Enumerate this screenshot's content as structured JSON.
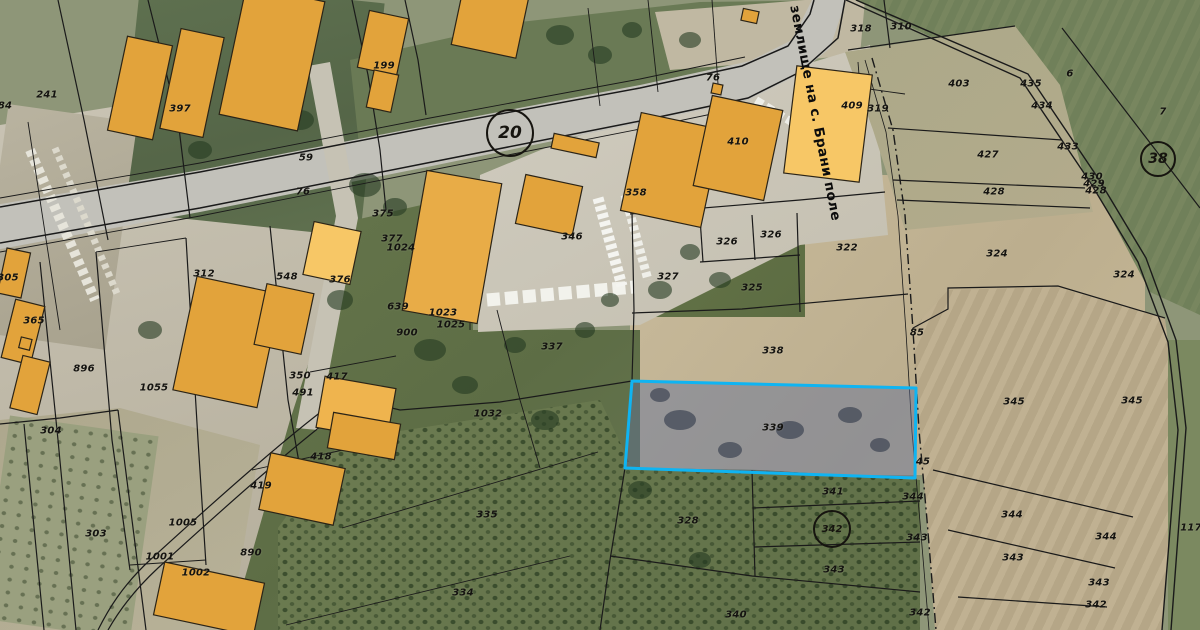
{
  "map": {
    "region_boundary_label": "землище на с. Брани поле",
    "selected_parcel": {
      "number": "339",
      "outline_color": "#0FB4F2",
      "fill_color": "rgba(96,110,152,0.45)"
    },
    "badges": [
      {
        "text": "20",
        "x": 510,
        "y": 133,
        "d": 44,
        "fs": 17
      },
      {
        "text": "38",
        "x": 1158,
        "y": 159,
        "d": 32,
        "fs": 14
      },
      {
        "text": "342",
        "x": 832,
        "y": 529,
        "d": 34,
        "fs": 10
      }
    ],
    "labels": [
      {
        "t": "84",
        "x": 5,
        "y": 106
      },
      {
        "t": "241",
        "x": 47,
        "y": 95
      },
      {
        "t": "397",
        "x": 180,
        "y": 109
      },
      {
        "t": "199",
        "x": 384,
        "y": 66
      },
      {
        "t": "59",
        "x": 306,
        "y": 158
      },
      {
        "t": "76",
        "x": 303,
        "y": 192
      },
      {
        "t": "76",
        "x": 713,
        "y": 78
      },
      {
        "t": "375",
        "x": 383,
        "y": 214
      },
      {
        "t": "376",
        "x": 340,
        "y": 280
      },
      {
        "t": "377",
        "x": 392,
        "y": 239
      },
      {
        "t": "1024",
        "x": 401,
        "y": 248
      },
      {
        "t": "639",
        "x": 398,
        "y": 307
      },
      {
        "t": "900",
        "x": 407,
        "y": 333
      },
      {
        "t": "1023",
        "x": 443,
        "y": 313
      },
      {
        "t": "1025",
        "x": 451,
        "y": 325
      },
      {
        "t": "346",
        "x": 572,
        "y": 237
      },
      {
        "t": "358",
        "x": 636,
        "y": 193
      },
      {
        "t": "312",
        "x": 204,
        "y": 274
      },
      {
        "t": "548",
        "x": 287,
        "y": 277
      },
      {
        "t": "305",
        "x": 8,
        "y": 278
      },
      {
        "t": "365",
        "x": 34,
        "y": 321
      },
      {
        "t": "896",
        "x": 84,
        "y": 369
      },
      {
        "t": "1055",
        "x": 154,
        "y": 388
      },
      {
        "t": "350",
        "x": 300,
        "y": 376
      },
      {
        "t": "491",
        "x": 303,
        "y": 393
      },
      {
        "t": "417",
        "x": 337,
        "y": 377
      },
      {
        "t": "418",
        "x": 321,
        "y": 457
      },
      {
        "t": "419",
        "x": 261,
        "y": 486
      },
      {
        "t": "890",
        "x": 251,
        "y": 553
      },
      {
        "t": "1005",
        "x": 183,
        "y": 523
      },
      {
        "t": "1001",
        "x": 160,
        "y": 557
      },
      {
        "t": "1002",
        "x": 196,
        "y": 573
      },
      {
        "t": "303",
        "x": 96,
        "y": 534
      },
      {
        "t": "304",
        "x": 51,
        "y": 431
      },
      {
        "t": "1032",
        "x": 488,
        "y": 414
      },
      {
        "t": "335",
        "x": 487,
        "y": 515
      },
      {
        "t": "334",
        "x": 463,
        "y": 593
      },
      {
        "t": "337",
        "x": 552,
        "y": 347
      },
      {
        "t": "327",
        "x": 668,
        "y": 277
      },
      {
        "t": "326",
        "x": 727,
        "y": 242
      },
      {
        "t": "326",
        "x": 771,
        "y": 235
      },
      {
        "t": "325",
        "x": 752,
        "y": 288
      },
      {
        "t": "322",
        "x": 847,
        "y": 248
      },
      {
        "t": "338",
        "x": 773,
        "y": 351
      },
      {
        "t": "339",
        "x": 773,
        "y": 428
      },
      {
        "t": "328",
        "x": 688,
        "y": 521
      },
      {
        "t": "340",
        "x": 736,
        "y": 615
      },
      {
        "t": "341",
        "x": 833,
        "y": 492
      },
      {
        "t": "343",
        "x": 834,
        "y": 570
      },
      {
        "t": "410",
        "x": 738,
        "y": 142
      },
      {
        "t": "409",
        "x": 852,
        "y": 106
      },
      {
        "t": "319",
        "x": 878,
        "y": 109
      },
      {
        "t": "318",
        "x": 861,
        "y": 29
      },
      {
        "t": "310",
        "x": 901,
        "y": 27
      },
      {
        "t": "403",
        "x": 959,
        "y": 84
      },
      {
        "t": "427",
        "x": 988,
        "y": 155
      },
      {
        "t": "428",
        "x": 994,
        "y": 192
      },
      {
        "t": "435",
        "x": 1031,
        "y": 84
      },
      {
        "t": "434",
        "x": 1042,
        "y": 106
      },
      {
        "t": "433",
        "x": 1068,
        "y": 147
      },
      {
        "t": "430",
        "x": 1092,
        "y": 177
      },
      {
        "t": "429",
        "x": 1094,
        "y": 184
      },
      {
        "t": "428",
        "x": 1096,
        "y": 191
      },
      {
        "t": "6",
        "x": 1070,
        "y": 74
      },
      {
        "t": "7",
        "x": 1163,
        "y": 112
      },
      {
        "t": "85",
        "x": 917,
        "y": 333
      },
      {
        "t": "324",
        "x": 997,
        "y": 254
      },
      {
        "t": "324",
        "x": 1124,
        "y": 275
      },
      {
        "t": "345",
        "x": 1014,
        "y": 402
      },
      {
        "t": "345",
        "x": 1132,
        "y": 401
      },
      {
        "t": "45",
        "x": 923,
        "y": 462
      },
      {
        "t": "344",
        "x": 913,
        "y": 497
      },
      {
        "t": "343",
        "x": 917,
        "y": 538
      },
      {
        "t": "342",
        "x": 920,
        "y": 613
      },
      {
        "t": "344",
        "x": 1012,
        "y": 515
      },
      {
        "t": "343",
        "x": 1013,
        "y": 558
      },
      {
        "t": "344",
        "x": 1106,
        "y": 537
      },
      {
        "t": "343",
        "x": 1099,
        "y": 583
      },
      {
        "t": "342",
        "x": 1096,
        "y": 605
      },
      {
        "t": "117",
        "x": 1191,
        "y": 528
      }
    ],
    "colors": {
      "building_fill": "#E2A33B",
      "building_fill_light": "#F7C766",
      "parcel_line": "#1a1a1a",
      "road_fill": "#c2c1ba"
    }
  }
}
